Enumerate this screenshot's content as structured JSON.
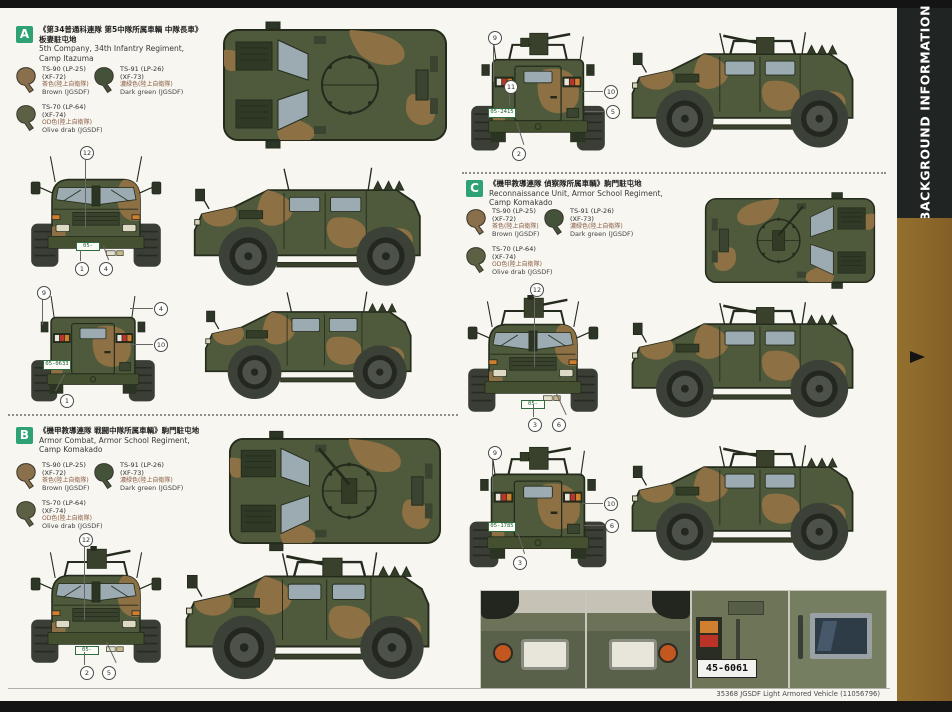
{
  "page": {
    "sidebar_title": "BACKGROUND INFORMATION",
    "footer": "35368 JGSDF Light Armored Vehicle (11056796)"
  },
  "colors": {
    "camo_green": "#4e5a3b",
    "camo_brown": "#8d7044",
    "sidebar_brown": "#8a672c",
    "section_label_green": "#2fa273"
  },
  "sections": {
    "A": {
      "label": "A",
      "jp1": "《第34普通科連隊 第5中隊所属車輌 中隊長車》",
      "jp2": "板妻駐屯地",
      "en1": "5th Company, 34th Infantry Regiment,",
      "en2": "Camp Itazuma"
    },
    "B": {
      "label": "B",
      "jp1": "《機甲教導連隊 戦闘中隊所属車輌》駒門駐屯地",
      "en1": "Armor Combat, Armor School Regiment,",
      "en2": "Camp Komakado"
    },
    "C": {
      "label": "C",
      "jp1": "《機甲教導連隊 偵察隊所属車輌》駒門駐屯地",
      "en1": "Reconnaissance Unit, Armor School Regiment,",
      "en2": "Camp Komakado"
    }
  },
  "paints": [
    {
      "code": "TS-90 (LP-25)",
      "code2": "(XF-72)",
      "jp": "茶色(陸上自衛隊)",
      "en": "Brown (JGSDF)",
      "color": "#8a6f4c"
    },
    {
      "code": "TS-91 (LP-26)",
      "code2": "(XF-73)",
      "jp": "濃緑色(陸上自衛隊)",
      "en": "Dark green (JGSDF)",
      "color": "#44523a"
    },
    {
      "code": "TS-70 (LP-64)",
      "code2": "(XF-74)",
      "jp": "OD色(陸上自衛隊)",
      "en": "Olive drab (JGSDF)",
      "color": "#5c6144"
    }
  ],
  "plates": {
    "a": "05-0633",
    "b": "05-2415",
    "c": "05-1785",
    "photo_rear": "45-6061"
  },
  "callouts": {
    "a_front": [
      "12",
      "1",
      "4"
    ],
    "a_rear": [
      "9",
      "4",
      "10",
      "1"
    ],
    "b_front": [
      "12",
      "2",
      "5"
    ],
    "b_rear": [
      "9",
      "11",
      "10",
      "5",
      "2"
    ],
    "c_front": [
      "12",
      "3",
      "6"
    ],
    "c_rear": [
      "9",
      "10",
      "6",
      "3"
    ]
  }
}
